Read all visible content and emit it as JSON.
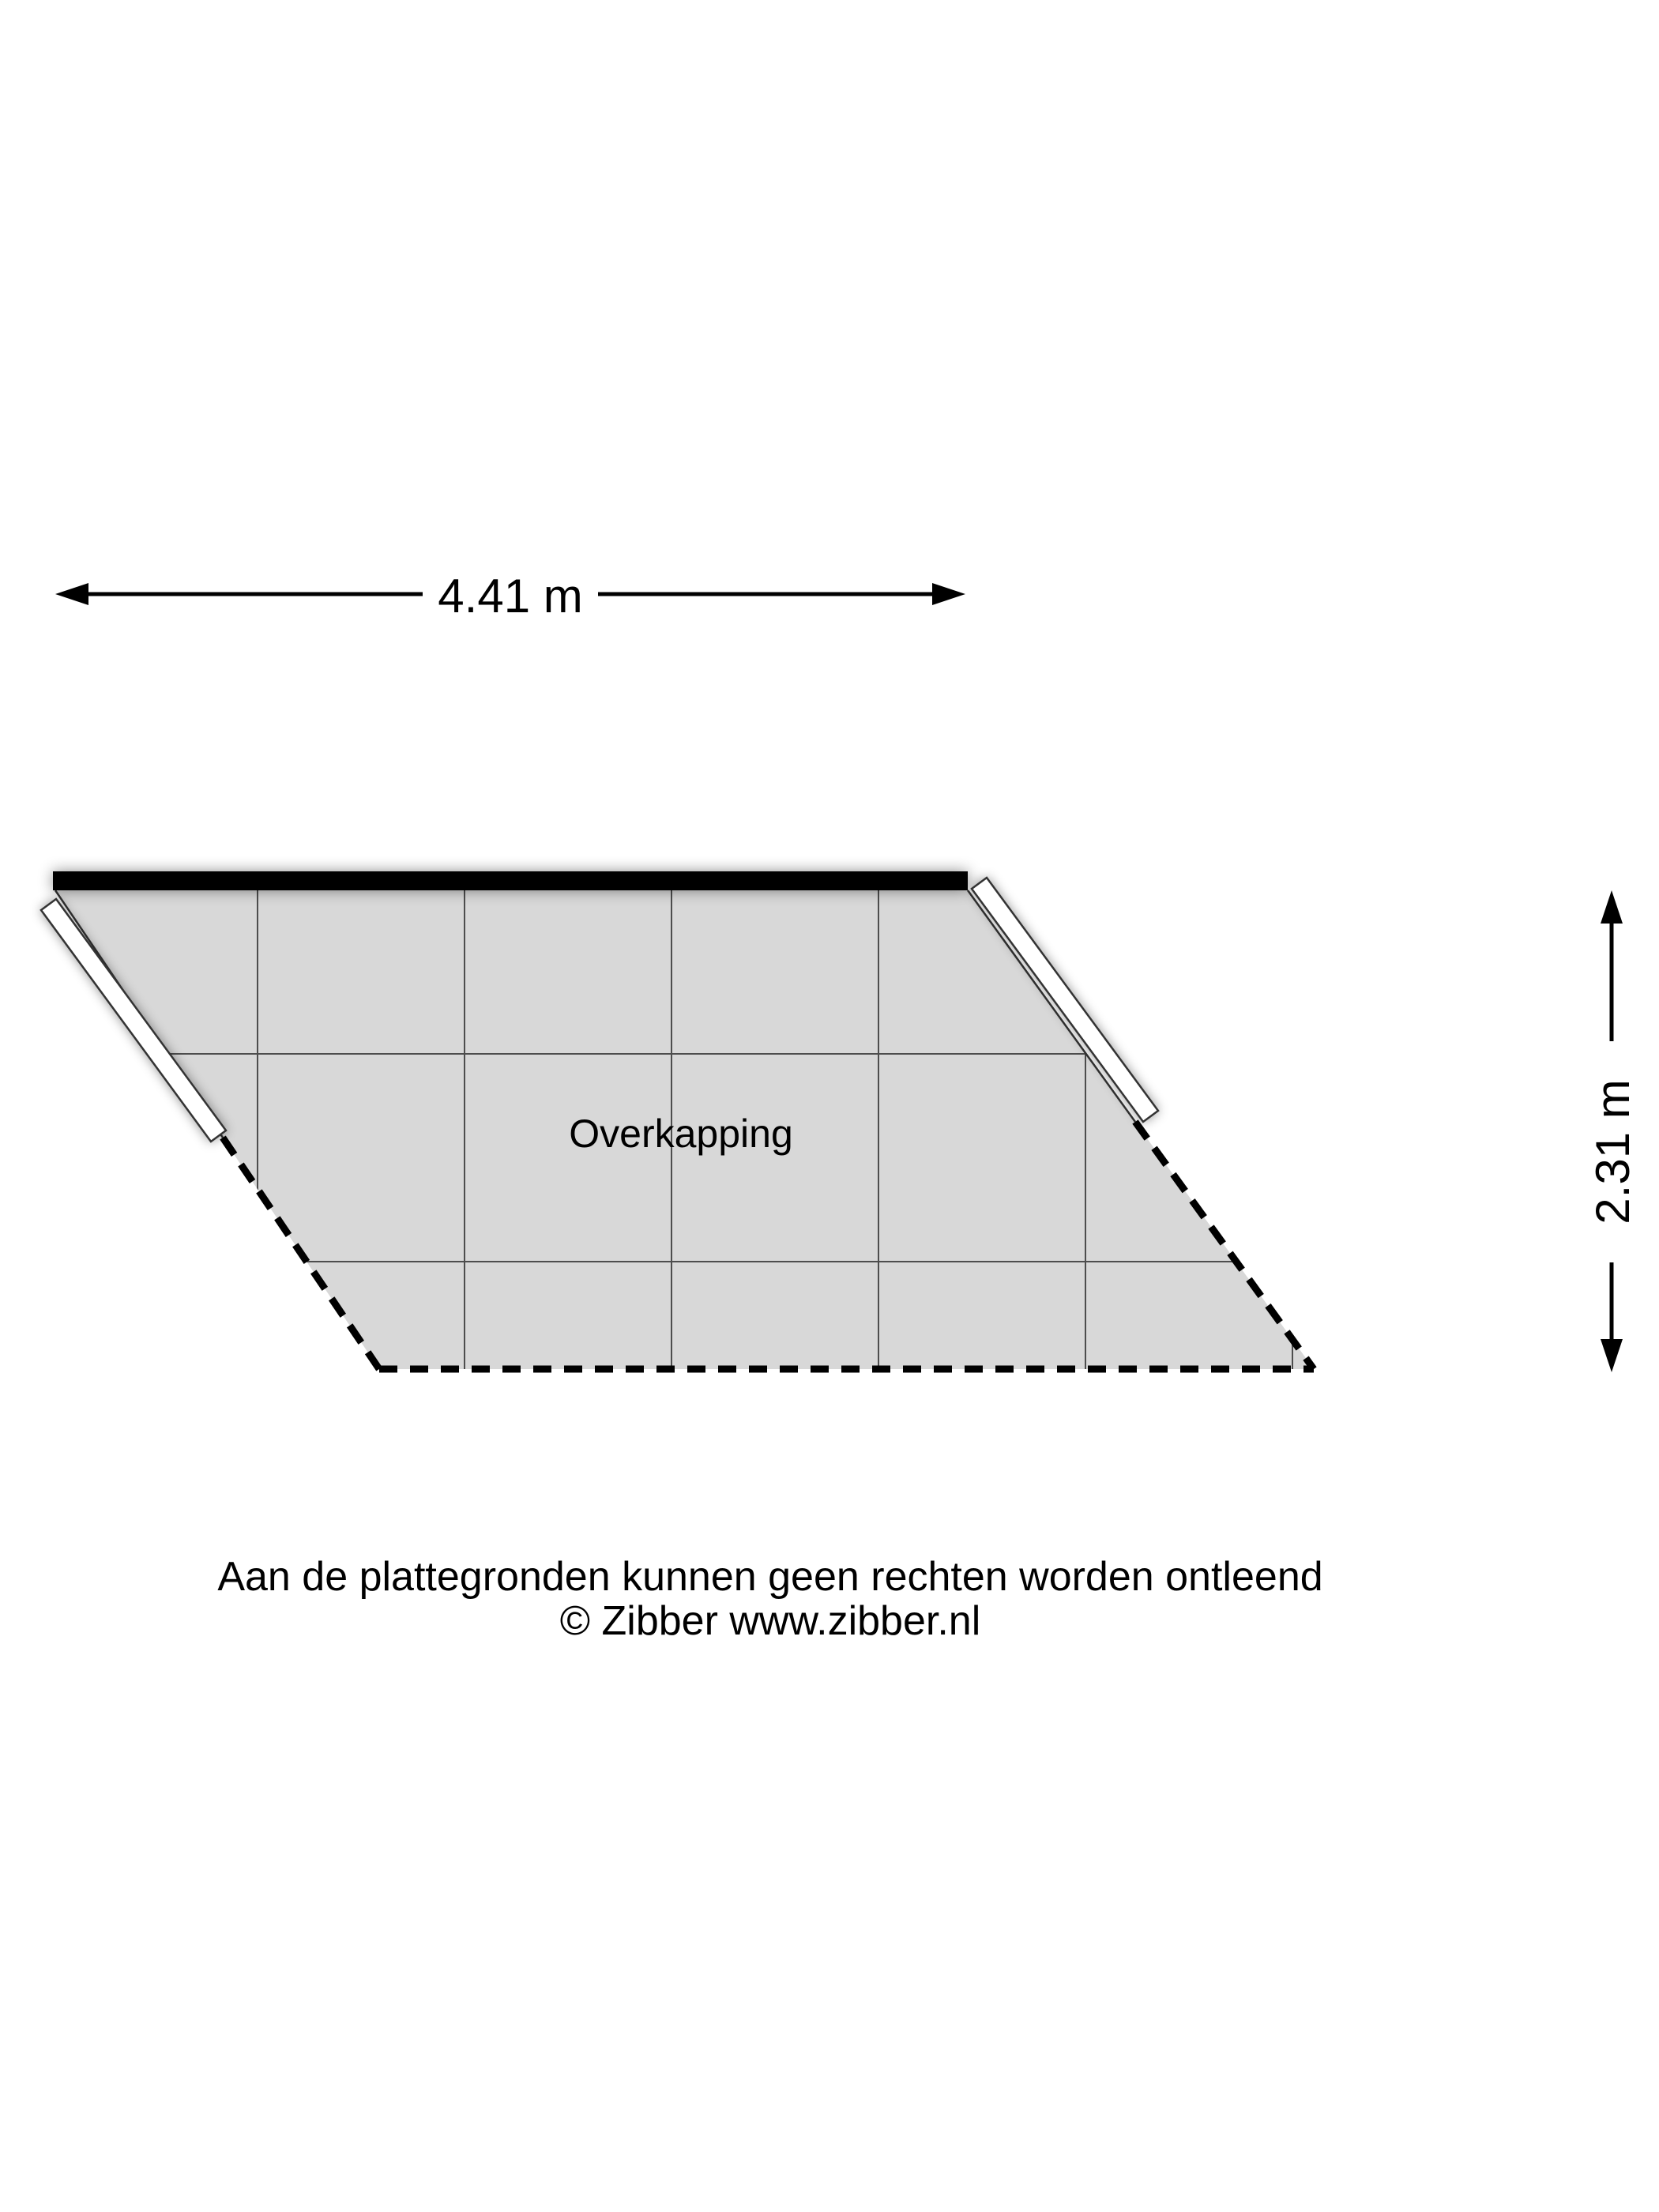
{
  "plan": {
    "room_label": "Overkapping"
  },
  "dimensions": {
    "top_width_label": "4.41 m",
    "right_depth_label": "2.31 m"
  },
  "footer": {
    "line1": "Aan de plattegronden kunnen geen rechten worden ontleend",
    "line2": "© Zibber www.zibber.nl"
  },
  "colors": {
    "background": "#ffffff",
    "tile_fill": "#d8d8d8",
    "grid_line": "#4d4d4d",
    "wall_black": "#000000",
    "open_wall_fill": "#ffffff",
    "open_wall_stroke": "#333333",
    "dashed_edge": "#000000",
    "dimension_line": "#000000",
    "text_color": "#000000"
  }
}
